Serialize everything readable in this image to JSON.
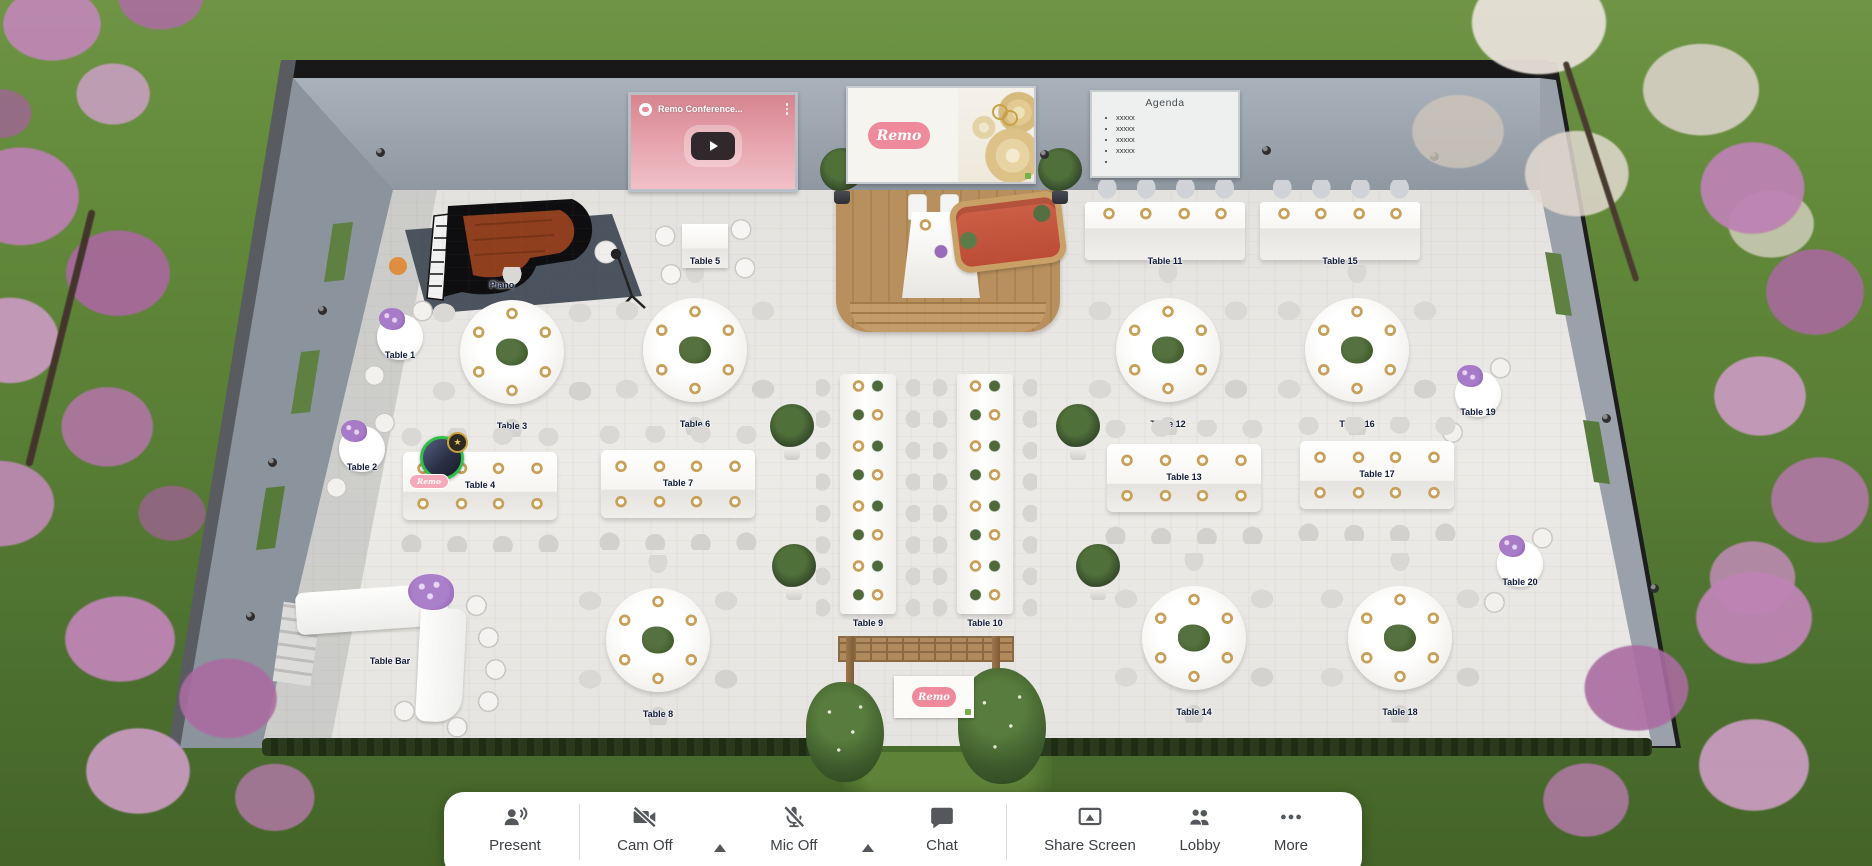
{
  "app": {
    "name": "Remo",
    "view": "wedding-floor-plan"
  },
  "scene": {
    "video_player": {
      "title": "Remo Conference...",
      "logo_text": "Remo"
    },
    "banner": {
      "logo_text": "Remo"
    },
    "agenda": {
      "title": "Agenda",
      "items": [
        "xxxxx",
        "xxxxx",
        "xxxxx",
        "xxxxx",
        ""
      ]
    },
    "arch_sign": {
      "logo_text": "Remo"
    },
    "avatar": {
      "name_tag": "Remo"
    }
  },
  "floor": {
    "tables": [
      {
        "id": "table-1",
        "label": "Table 1",
        "type": "cocktail"
      },
      {
        "id": "table-2",
        "label": "Table 2",
        "type": "cocktail"
      },
      {
        "id": "table-3",
        "label": "Table 3",
        "type": "round-6"
      },
      {
        "id": "table-4",
        "label": "Table 4",
        "type": "rect-8"
      },
      {
        "id": "table-5",
        "label": "Table 5",
        "type": "square-4"
      },
      {
        "id": "table-6",
        "label": "Table 6",
        "type": "round-6"
      },
      {
        "id": "table-7",
        "label": "Table 7",
        "type": "rect-8"
      },
      {
        "id": "table-8",
        "label": "Table 8",
        "type": "round-6"
      },
      {
        "id": "table-9",
        "label": "Table 9",
        "type": "banquet-8"
      },
      {
        "id": "table-10",
        "label": "Table 10",
        "type": "banquet-8"
      },
      {
        "id": "table-11",
        "label": "Table 11",
        "type": "head-4"
      },
      {
        "id": "table-12",
        "label": "Table 12",
        "type": "round-6"
      },
      {
        "id": "table-13",
        "label": "Table 13",
        "type": "rect-8"
      },
      {
        "id": "table-14",
        "label": "Table 14",
        "type": "round-6"
      },
      {
        "id": "table-15",
        "label": "Table 15",
        "type": "head-4"
      },
      {
        "id": "table-16",
        "label": "Table 16",
        "type": "round-6"
      },
      {
        "id": "table-17",
        "label": "Table 17",
        "type": "rect-8"
      },
      {
        "id": "table-18",
        "label": "Table 18",
        "type": "round-6"
      },
      {
        "id": "table-19",
        "label": "Table 19",
        "type": "cocktail"
      },
      {
        "id": "table-20",
        "label": "Table 20",
        "type": "cocktail"
      },
      {
        "id": "table-bar",
        "label": "Table Bar",
        "type": "bar"
      },
      {
        "id": "piano",
        "label": "Piano",
        "type": "piano-area"
      }
    ]
  },
  "toolbar": {
    "buttons": [
      {
        "id": "present",
        "label": "Present",
        "icon": "present-icon",
        "caret": false
      },
      {
        "id": "cam-off",
        "label": "Cam Off",
        "icon": "camera-off-icon",
        "caret": true
      },
      {
        "id": "mic-off",
        "label": "Mic Off",
        "icon": "mic-off-icon",
        "caret": true
      },
      {
        "id": "chat",
        "label": "Chat",
        "icon": "chat-icon",
        "caret": false
      },
      {
        "id": "share-screen",
        "label": "Share Screen",
        "icon": "share-screen-icon",
        "caret": false
      },
      {
        "id": "lobby",
        "label": "Lobby",
        "icon": "lobby-icon",
        "caret": false
      },
      {
        "id": "more",
        "label": "More",
        "icon": "more-icon",
        "caret": false
      }
    ]
  },
  "colors": {
    "accent_pink": "#ee8a9c",
    "avatar_ring_green": "#2fbf4a",
    "toolbar_icon": "#54575b",
    "wall_gray": "#9aa2ac",
    "floor_light": "#e9e7e3",
    "stage_wood": "#b8905e",
    "couch_red": "#c4543c",
    "grass_green": "#648a3c",
    "blossom_pink": "#bc84b4",
    "gold_plate": "#c9a05a",
    "label_navy": "#101b3c"
  }
}
